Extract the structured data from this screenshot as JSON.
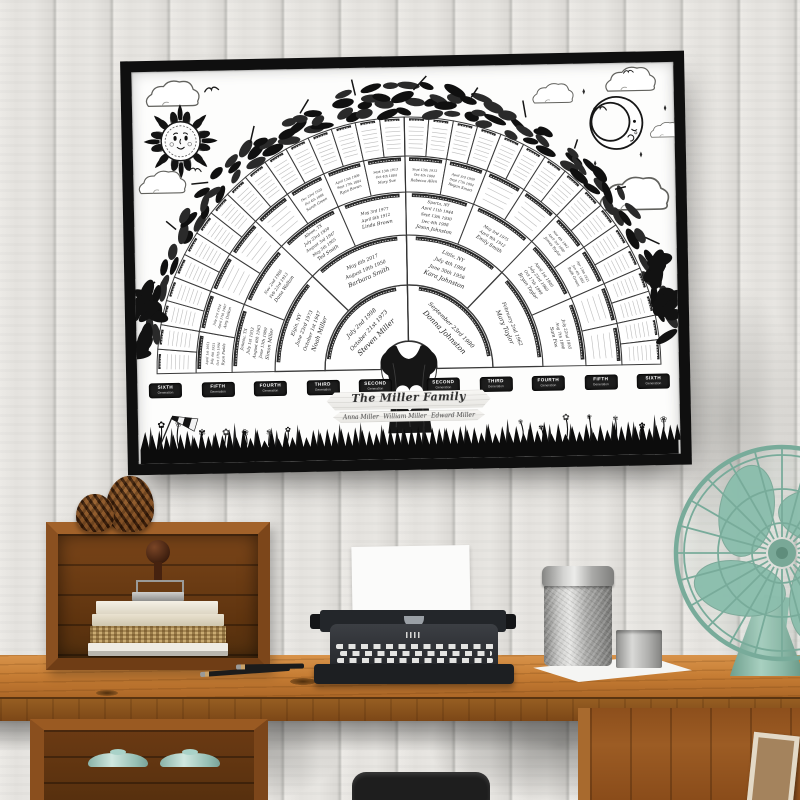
{
  "poster": {
    "title": "The Miller Family",
    "children": [
      "Anna Miller",
      "William Miller",
      "Edward Miller"
    ],
    "generation_sublabel": "Generation",
    "generation_labels_left": [
      "SIXTH",
      "FIFTH",
      "FOURTH",
      "THIRD",
      "SECOND"
    ],
    "generation_labels_right": [
      "SECOND",
      "THIRD",
      "FOURTH",
      "FIFTH",
      "SIXTH"
    ],
    "fan": {
      "rings": [
        {
          "count": 2,
          "filled": [
            {
              "index": 0,
              "lines": [
                "Steven Miller",
                "October 21st 1973",
                "July 2nd 1998"
              ]
            },
            {
              "index": 1,
              "lines": [
                "Donna Johnston",
                "September 23rd 1980"
              ]
            }
          ]
        },
        {
          "count": 4,
          "filled": [
            {
              "index": 0,
              "lines": [
                "Noah Miller",
                "October 1st 1947",
                "June 23rd 1973",
                "Elgin, NY"
              ]
            },
            {
              "index": 1,
              "lines": [
                "Barbara Smith",
                "August 10th 1950",
                "May 6th 2017"
              ]
            },
            {
              "index": 2,
              "lines": [
                "Kara Johnston",
                "June 30th 1956",
                "July 4th 1984",
                "Little, NY"
              ]
            },
            {
              "index": 3,
              "lines": [
                "Mary Taylor",
                "February 2nd 1962"
              ]
            }
          ]
        },
        {
          "count": 8,
          "filled": [
            {
              "index": 0,
              "lines": [
                "Simon Miller",
                "June 13th 1909",
                "August 6th 1963",
                "July 1st 1933",
                "Juneau, TX"
              ]
            },
            {
              "index": 1,
              "lines": [
                "Dana Walton",
                "Feb 23rd 1913",
                "Nov 2nd 1986"
              ]
            },
            {
              "index": 2,
              "lines": [
                "Ted Smith",
                "May 5th 1905",
                "August 3rd 1947",
                "July 23rd 1930",
                "Albion, TX"
              ]
            },
            {
              "index": 3,
              "lines": [
                "Linda Brown",
                "April 8th 1912",
                "May 3rd 1977"
              ]
            },
            {
              "index": 4,
              "lines": [
                "Jason Johnston",
                "Dec 4th 1908",
                "Sept 13th 1930",
                "April 11th 1944",
                "Sparta, NY"
              ]
            },
            {
              "index": 5,
              "lines": [
                "Emily Smith",
                "April 9th 1912",
                "May 3rd 1975"
              ]
            },
            {
              "index": 6,
              "lines": [
                "Bryan Taylor",
                "Oct 17th 1899",
                "July 23rd 1960",
                "April 1st 1940"
              ]
            },
            {
              "index": 7,
              "lines": [
                "Sam Fox",
                "Aug 7th 1890",
                "July 22nd 1955"
              ]
            }
          ]
        },
        {
          "count": 16,
          "filled": [
            {
              "index": 0,
              "lines": [
                "Ryan Fields",
                "Oct 17th 1904",
                "July 4th 1921",
                "April 1st 1951"
              ]
            },
            {
              "index": 1,
              "lines": [
                "Amy Dalton",
                "April 17th 1907",
                "July 3rd 1954"
              ]
            },
            {
              "index": 5,
              "lines": [
                "Sarah Green",
                "Oct 4th 1888",
                "Dec 23rd 1935"
              ]
            },
            {
              "index": 6,
              "lines": [
                "Ryan Brown",
                "Sept 17th 1884",
                "April 13th 1909"
              ]
            },
            {
              "index": 7,
              "lines": [
                "Mary Sue",
                "Oct 4th 1884",
                "Sept 13th 1913"
              ]
            },
            {
              "index": 8,
              "lines": [
                "Rebecca Allen",
                "Oct 4th 1884",
                "Sept 13th 1913"
              ]
            },
            {
              "index": 9,
              "lines": [
                "Regan Smart",
                "Sept 17th 1884",
                "April 3rd 1909"
              ]
            },
            {
              "index": 12,
              "lines": [
                "James Taylor",
                "April 3rd 1880",
                "Nov 4th 1942"
              ]
            },
            {
              "index": 13,
              "lines": [
                "Ruth Green",
                "Jan 4th 1882",
                "Apr 13th 1921"
              ]
            }
          ]
        },
        {
          "count": 32,
          "filled": []
        }
      ]
    }
  },
  "colors": {
    "frame": "#0f0f0f",
    "poster_paper": "#fdfdfc",
    "ink": "#1f1f1f",
    "wall_plank": "#e6e5e1",
    "desk_wood": "#c67d34",
    "crate_wood": "#7c461a",
    "typewriter_black": "#26282c",
    "canister_metal": "#b9b9b7",
    "fan_mint": "#8cbfae",
    "jar_mint": "#a9d2c8"
  }
}
